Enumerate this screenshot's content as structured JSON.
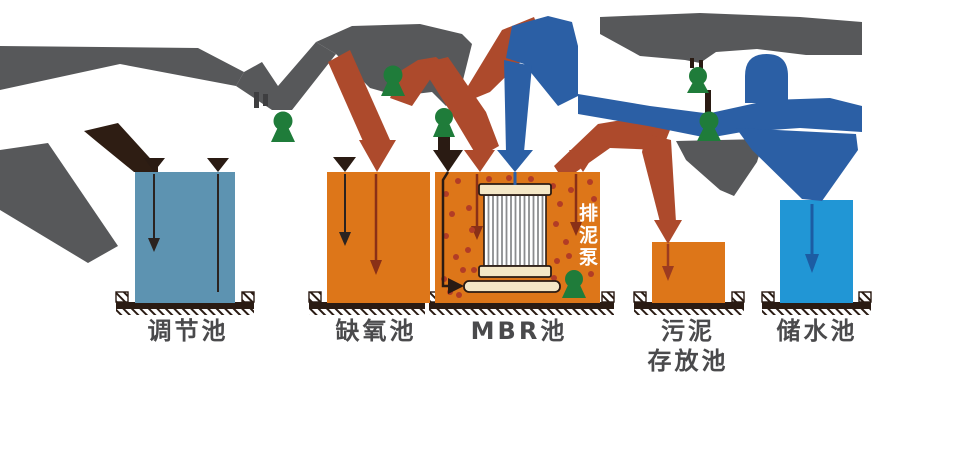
{
  "diagram": {
    "type": "process-flow",
    "subject": "MBR wastewater treatment process",
    "tanks": [
      {
        "id": "regulating",
        "label": "调节池",
        "color": "#5d93b1"
      },
      {
        "id": "anoxic",
        "label": "缺氧池",
        "color": "#dd7619"
      },
      {
        "id": "mbr",
        "label": "MBR池",
        "color": "#dd7619"
      },
      {
        "id": "sludge-storage",
        "label": "污泥\n存放池",
        "color": "#dd7619"
      },
      {
        "id": "water-storage",
        "label": "储水池",
        "color": "#2196d5"
      }
    ],
    "mbr": {
      "pump_label": "排泥泵"
    },
    "colors": {
      "pipe_gray": "#57585a",
      "pipe_red": "#ad4a2c",
      "pipe_blue": "#2b5fa5",
      "pump_green": "#1f7c3a",
      "ground_dark": "#2a1b13",
      "membrane_beige": "#f4e7c6",
      "dot_red": "#b23c26",
      "label_text": "#4a4a4c",
      "inner_arrow_dark": "#2b2320",
      "inner_arrow_red": "#8a3017",
      "inner_arrow_blue": "#1c5ca3"
    }
  }
}
